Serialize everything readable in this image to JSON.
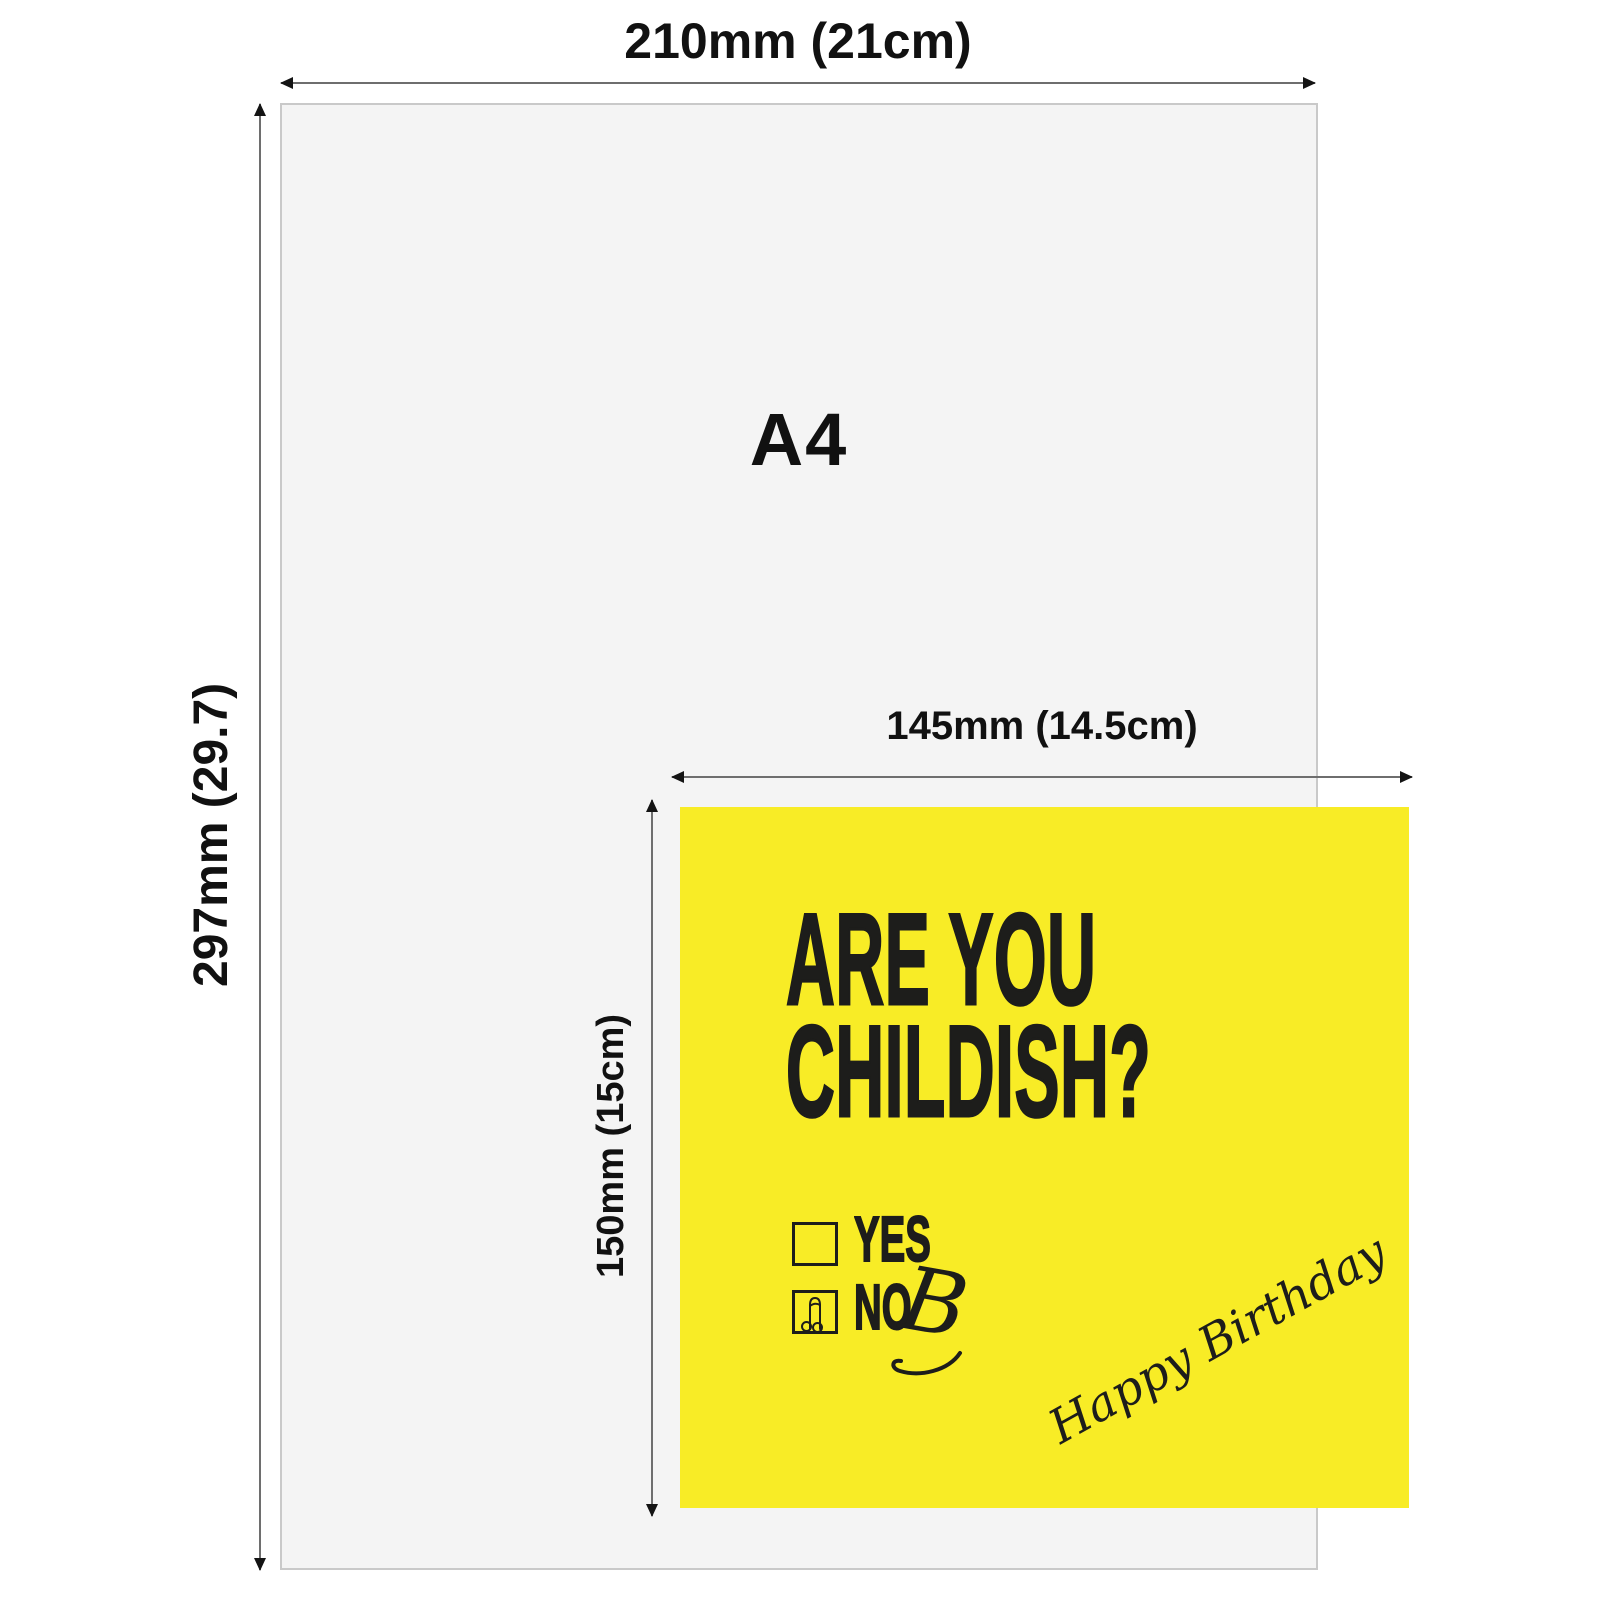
{
  "diagram": {
    "type": "size-comparison",
    "a4": {
      "label": "A4",
      "width_label": "210mm (21cm)",
      "height_label": "297mm (29.7)",
      "fill": "#f4f4f4",
      "border_color": "#c9c9c9"
    },
    "card": {
      "width_label": "145mm (14.5cm)",
      "height_label": "150mm (15cm)",
      "fill": "#f8ec26",
      "headline_line1": "ARE YOU",
      "headline_line2": "CHILDISH?",
      "options": [
        {
          "label": "YES",
          "checked": false
        },
        {
          "label": "NO",
          "checked": true,
          "check_icon": "willy-doodle-icon"
        }
      ],
      "no_suffix": "B",
      "script_text": "Happy Birthday",
      "text_color": "#1d1d1b"
    },
    "colors": {
      "background": "#ffffff",
      "dimension_line": "#6e6e6e",
      "arrowhead": "#141414",
      "label_text": "#111111"
    }
  }
}
